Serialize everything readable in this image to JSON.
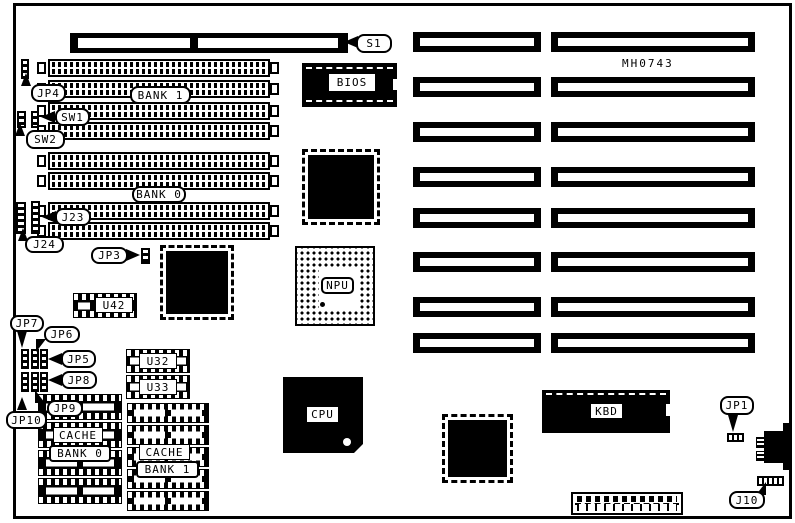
{
  "board": {
    "part_number": "MH0743",
    "memory": {
      "bank1": "BANK 1",
      "bank0": "BANK 0"
    },
    "cache": {
      "left_cache": "CACHE",
      "left_bank": "BANK 0",
      "right_cache": "CACHE",
      "right_bank": "BANK 1"
    },
    "chips": {
      "bios": "BIOS",
      "npu": "NPU",
      "cpu": "CPU",
      "kbd": "KBD",
      "u42": "U42",
      "u32": "U32",
      "u33": "U33"
    },
    "connectors": {
      "s1": "S1",
      "j23": "J23",
      "j24": "J24",
      "j10": "J10"
    },
    "switches": {
      "sw1": "SW1",
      "sw2": "SW2"
    },
    "jumpers": {
      "jp1": "JP1",
      "jp3": "JP3",
      "jp4": "JP4",
      "jp5": "JP5",
      "jp6": "JP6",
      "jp7": "JP7",
      "jp8": "JP8",
      "jp9": "JP9",
      "jp10": "JP10"
    }
  }
}
